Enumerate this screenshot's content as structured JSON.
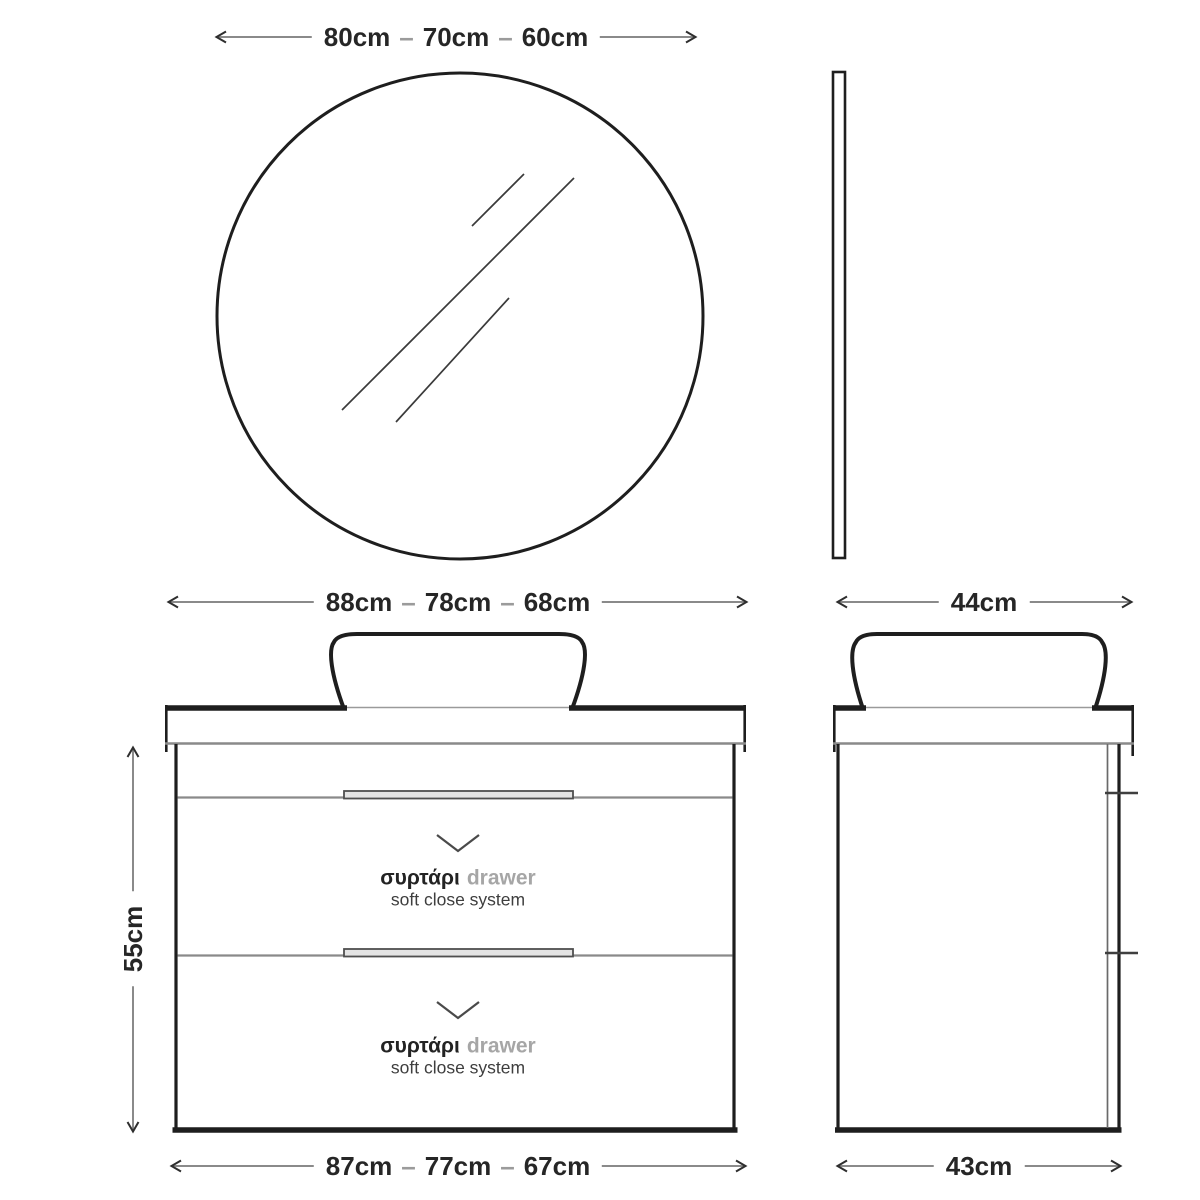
{
  "dimensions": {
    "separator": "–",
    "mirror_width": {
      "values": [
        "80cm",
        "70cm",
        "60cm"
      ]
    },
    "vanity_width_top": {
      "values": [
        "88cm",
        "78cm",
        "68cm"
      ]
    },
    "vanity_width_bottom": {
      "values": [
        "87cm",
        "77cm",
        "67cm"
      ]
    },
    "vanity_height": {
      "value": "55cm"
    },
    "side_depth_top": {
      "value": "44cm"
    },
    "side_depth_bottom": {
      "value": "43cm"
    }
  },
  "drawers": [
    {
      "label_greek": "συρτάρι",
      "label_en": "drawer",
      "subtitle": "soft close system"
    },
    {
      "label_greek": "συρτάρι",
      "label_en": "drawer",
      "subtitle": "soft close system"
    }
  ],
  "colors": {
    "line_dark": "#1e1e1e",
    "line_gray": "#8a8a8a",
    "text_dark": "#262626",
    "text_gray_light": "#a6a6a6",
    "text_gray_mid": "#3e3e3e"
  }
}
